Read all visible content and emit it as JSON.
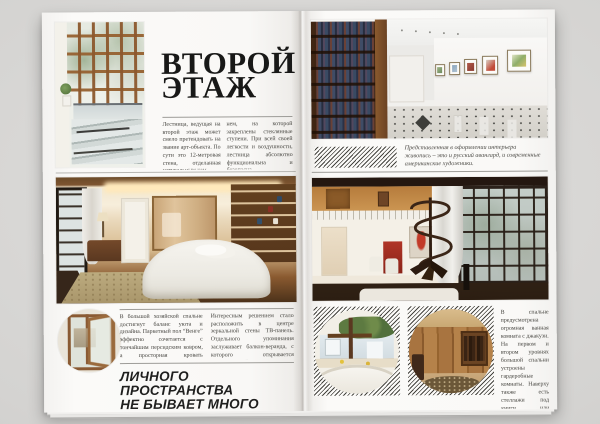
{
  "colors": {
    "background": "#d4d3d1",
    "paper": "#faf9f7",
    "title_ink": "#181817",
    "body_ink": "#45443f",
    "rule": "#9d9c98",
    "hatch_ink": "#45443f"
  },
  "left_page": {
    "title": {
      "line1": "ВТОРОЙ",
      "line2": "ЭТАЖ"
    },
    "intro": {
      "col1": "Лестница, ведущая на второй этаж может смело претендовать на звание арт-объекта. По сути это 12-метровая стена, отделанная натуральным кам-",
      "col2": "нем, на которой закреплены стеклянные ступени. При всей своей легкости и воздушности, лестница абсолютно функциональна и безопасна."
    },
    "lower": {
      "col1": "В большой хозяйской спальне достигнут баланс уюта и дизайна. Паркетный пол “Венге” эффектно сочетается с тончайшим персидским ковром, а просторная кровать приглашает к отдыху.",
      "col2": "Интересным решением стало расположить в центре зеркальной стены ТВ-панель. Отдельного упоминания заслуживает балкон-веранда, с которого открывается замечательный вид на весь сад."
    },
    "headline": {
      "line1": "ЛИЧНОГО ПРОСТРАНСТВА",
      "line2": "НЕ БЫВАЕТ МНОГО"
    },
    "photos": {
      "atrium": "glass-atrium-with-wooden-skylight-and-glass-stairs",
      "bedroom": "master-bedroom-with-white-bed-persian-rug-and-wooden-shelves",
      "window_detail": "open-wooden-window-detail"
    }
  },
  "right_page": {
    "caption": "Представленная в оформлении интерьера живопись – это и русский авангард, и современные американские художники.",
    "side_column": "В спальне предусмотрена огромная ванная комната с джакузи. На первом и втором уровнях большой спальни устроены гардеробные комнаты. Наверху также есть стеллажи под книги или декоративные элементы интерьера.",
    "photos": {
      "gallery": "library-hall-with-bookshelves-and-framed-paintings",
      "living_room": "double-height-living-room-with-spiral-staircase",
      "bathroom": "bathroom-with-jacuzzi-plants-and-mirror",
      "wardrobe": "wardrobe-room-with-wooden-closets-and-oval-rug"
    }
  }
}
